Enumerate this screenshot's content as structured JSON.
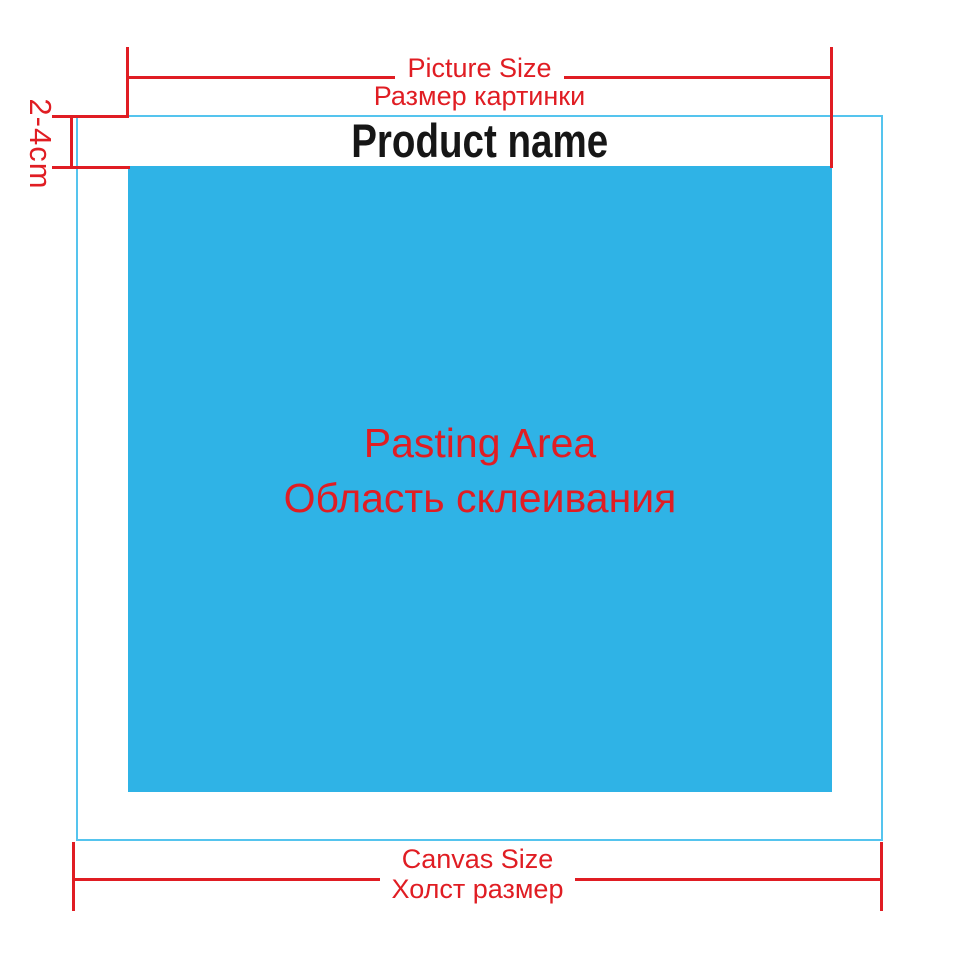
{
  "labels": {
    "picture_size_en": "Picture Size",
    "picture_size_ru": "Размер картинки",
    "margin": "2-4cm",
    "product_name": "Product name",
    "pasting_area_en": "Pasting Area",
    "pasting_area_ru": "Область склеивания",
    "canvas_size_en": "Canvas Size",
    "canvas_size_ru": "Холст размер"
  },
  "colors": {
    "dimension-red": "#e01d23",
    "pasting-blue": "#2fb3e6",
    "canvas-border-blue": "#55c4ee",
    "text-black": "#161616",
    "background": "#ffffff"
  }
}
